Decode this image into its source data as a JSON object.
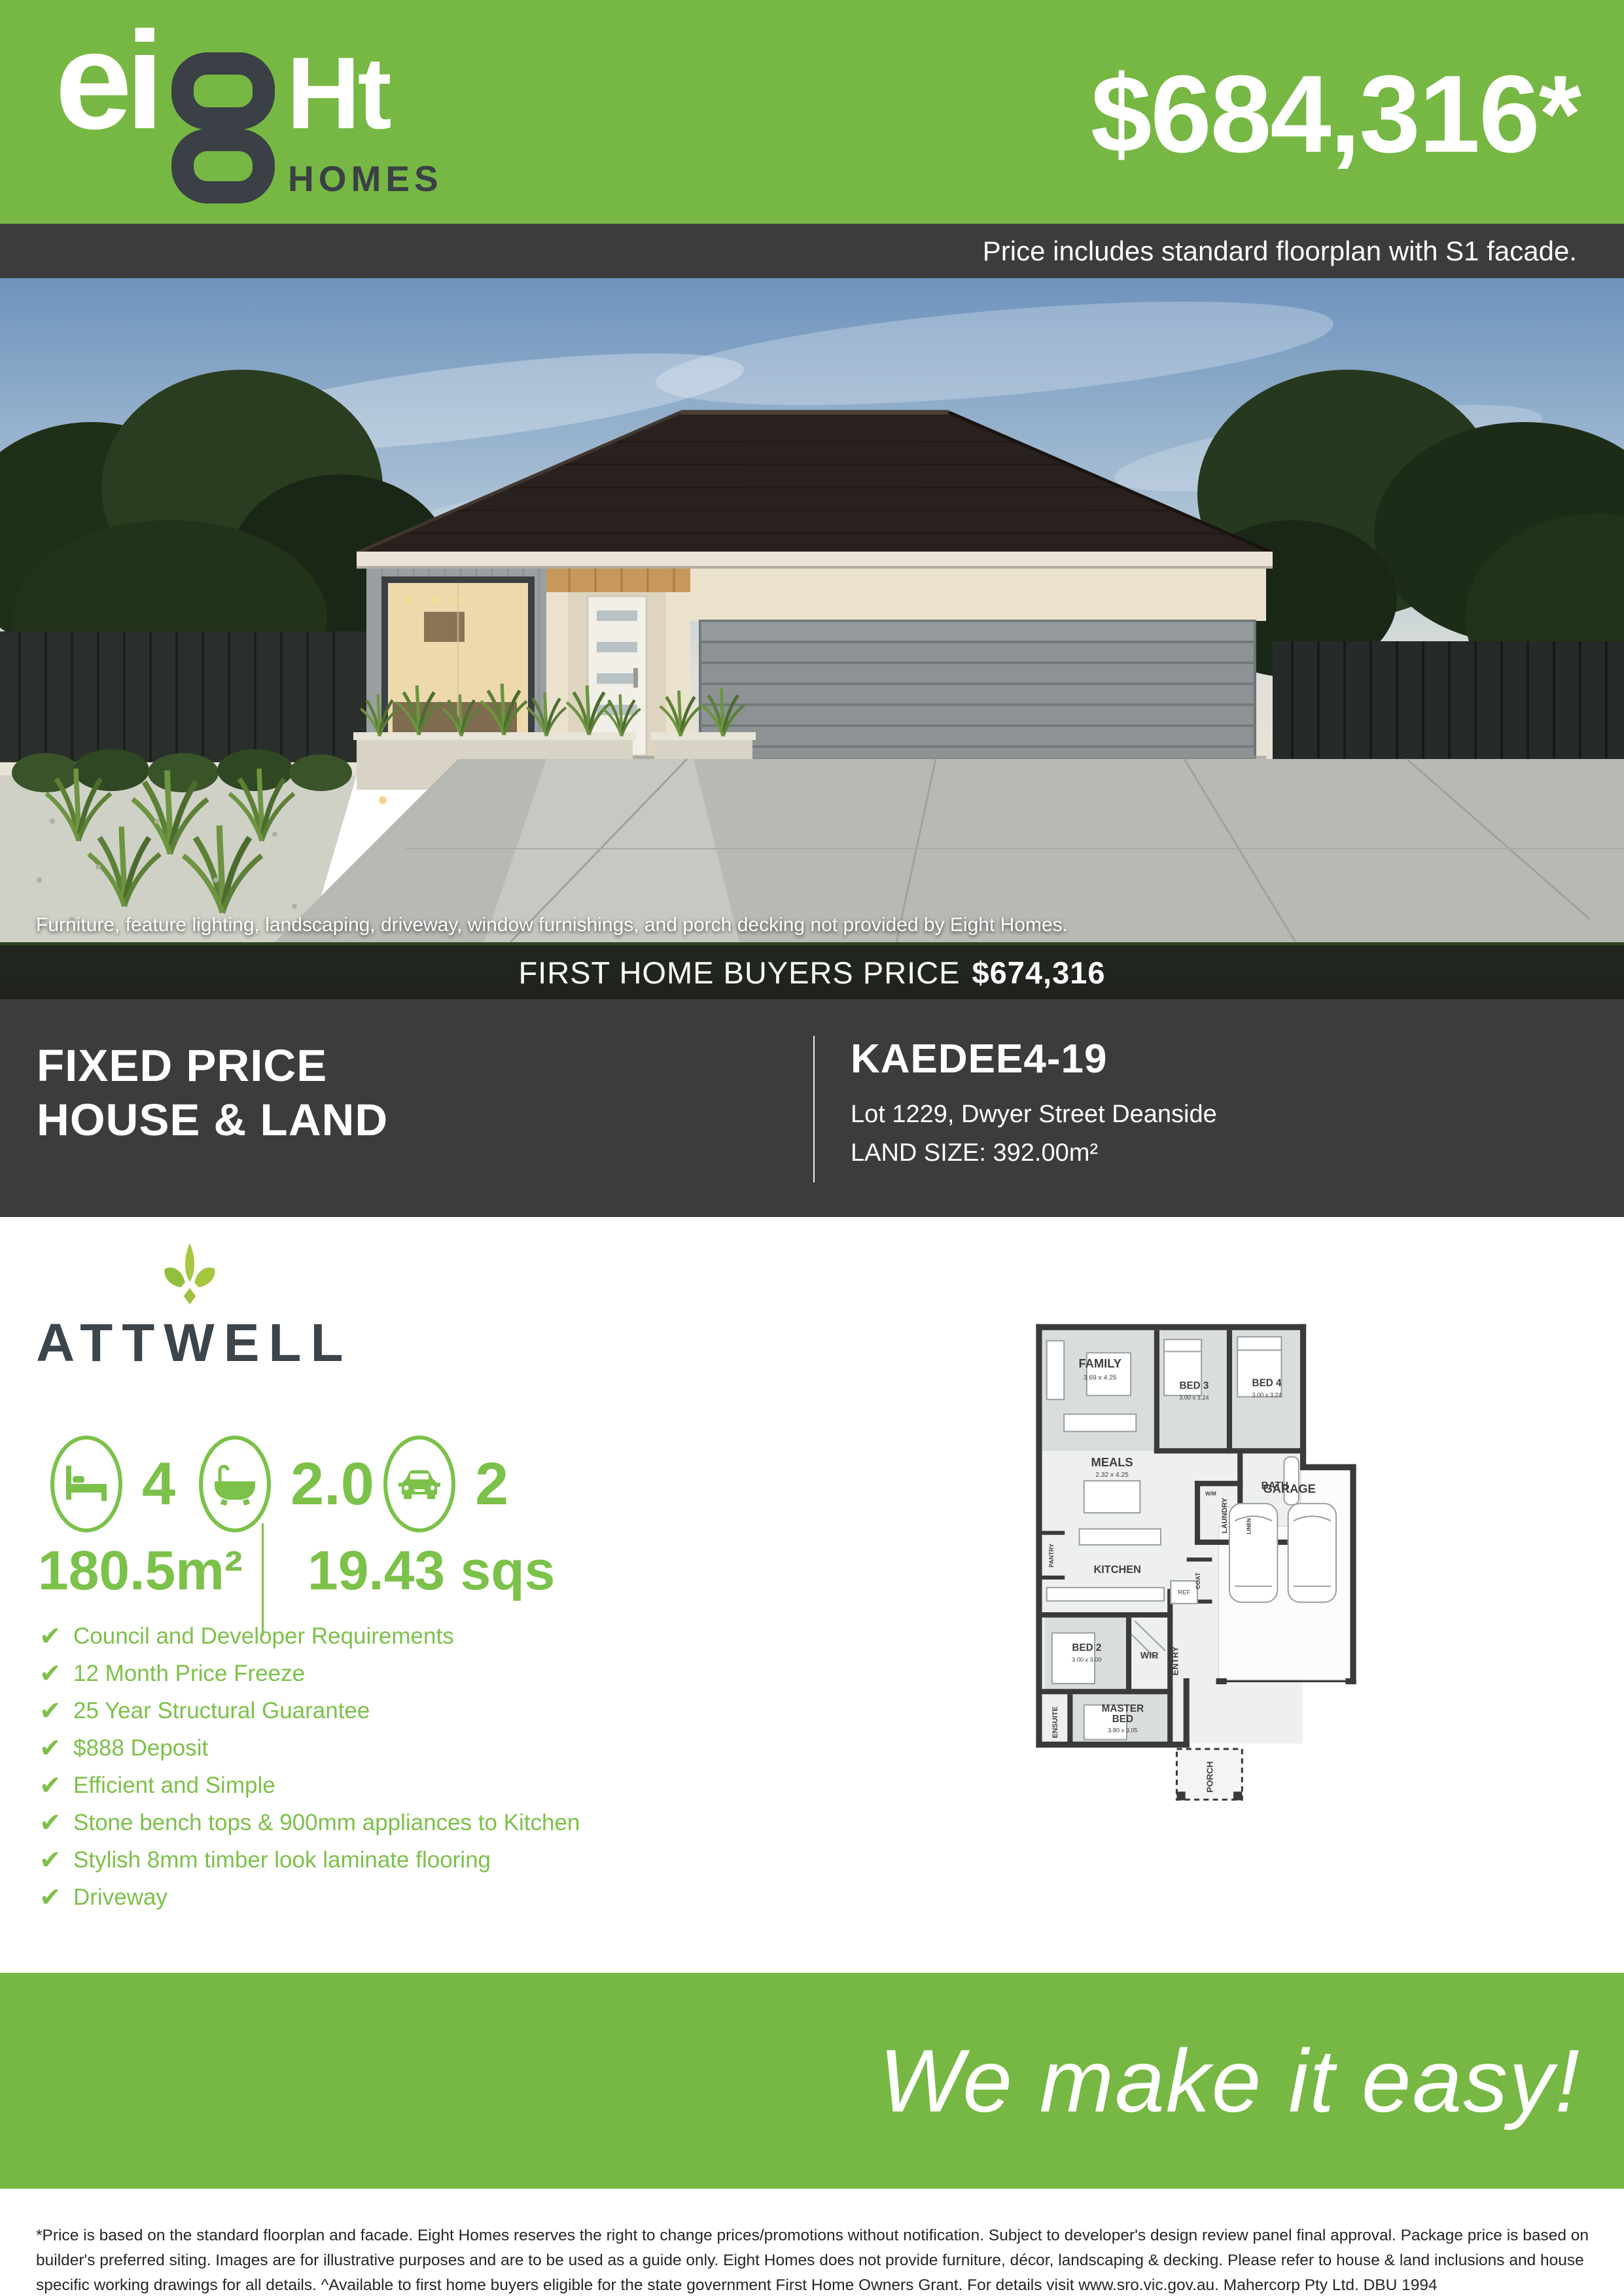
{
  "colors": {
    "brand_green": "#76b843",
    "text_green": "#7cc14a",
    "dark": "#3d3c3c",
    "slate": "#3c444c"
  },
  "header": {
    "logo_ei": "ei",
    "logo_eight_digit": "8",
    "logo_ht": "Ht",
    "logo_homes": "HOMES",
    "price": "$684,316*",
    "price_note": "Price includes standard floorplan with S1 facade."
  },
  "photo": {
    "caption": "Furniture, feature lighting, landscaping, driveway, window furnishings, and porch decking not provided by Eight Homes.",
    "fhb_label": "FIRST HOME BUYERS PRICE",
    "fhb_price": "$674,316"
  },
  "info": {
    "title_line1": "FIXED PRICE",
    "title_line2": "HOUSE & LAND",
    "plan_name": "KAEDEE4-19",
    "address": "Lot 1229, Dwyer Street Deanside",
    "land_size": "LAND SIZE: 392.00m²"
  },
  "home": {
    "name": "ATTWELL",
    "stats": [
      {
        "icon": "bed-icon",
        "value": "4"
      },
      {
        "icon": "bath-icon",
        "value": "2.0"
      },
      {
        "icon": "car-icon",
        "value": "2"
      }
    ],
    "area_m2": "180.5m²",
    "area_sqs": "19.43 sqs",
    "features": [
      "Council and Developer Requirements",
      "12 Month Price Freeze",
      "25 Year Structural Guarantee",
      "$888 Deposit",
      "Efficient and Simple",
      "Stone bench tops & 900mm appliances to Kitchen",
      "Stylish 8mm timber look laminate flooring",
      "Driveway"
    ]
  },
  "floorplan": {
    "rooms": [
      {
        "name": "FAMILY",
        "dims": "3.69 x 4.25"
      },
      {
        "name": "BED 3",
        "dims": "3.00 x 3.24"
      },
      {
        "name": "BED 4",
        "dims": "3.00 x 3.24"
      },
      {
        "name": "MEALS",
        "dims": "2.32 x 4.25"
      },
      {
        "name": "KITCHEN"
      },
      {
        "name": "PANTRY"
      },
      {
        "name": "W/M"
      },
      {
        "name": "LAUNDRY"
      },
      {
        "name": "LINEN"
      },
      {
        "name": "BATH"
      },
      {
        "name": "COAT"
      },
      {
        "name": "REF"
      },
      {
        "name": "GARAGE"
      },
      {
        "name": "BED 2",
        "dims": "3.00 x 3.00"
      },
      {
        "name": "WIR"
      },
      {
        "name": "ENTRY"
      },
      {
        "l1": "MASTER",
        "l2": "BED",
        "dims": "3.80 x 3.05"
      },
      {
        "name": "ENSUITE"
      },
      {
        "name": "PORCH"
      }
    ]
  },
  "footer": {
    "tagline": "We make it easy!",
    "disclaimer": "*Price is based on the standard floorplan and facade. Eight Homes reserves the right to change prices/promotions without notification. Subject to developer's design review panel final approval. Package price is based on builder's preferred siting. Images are for illustrative purposes and are to be used as a guide only. Eight Homes does not provide furniture, décor, landscaping & decking. Please refer to house & land inclusions and house specific working drawings for all details. ^Available to first home buyers eligible for the state government First Home Owners Grant. For details visit www.sro.vic.gov.au. Mahercorp Pty Ltd. DBU 1994"
  }
}
